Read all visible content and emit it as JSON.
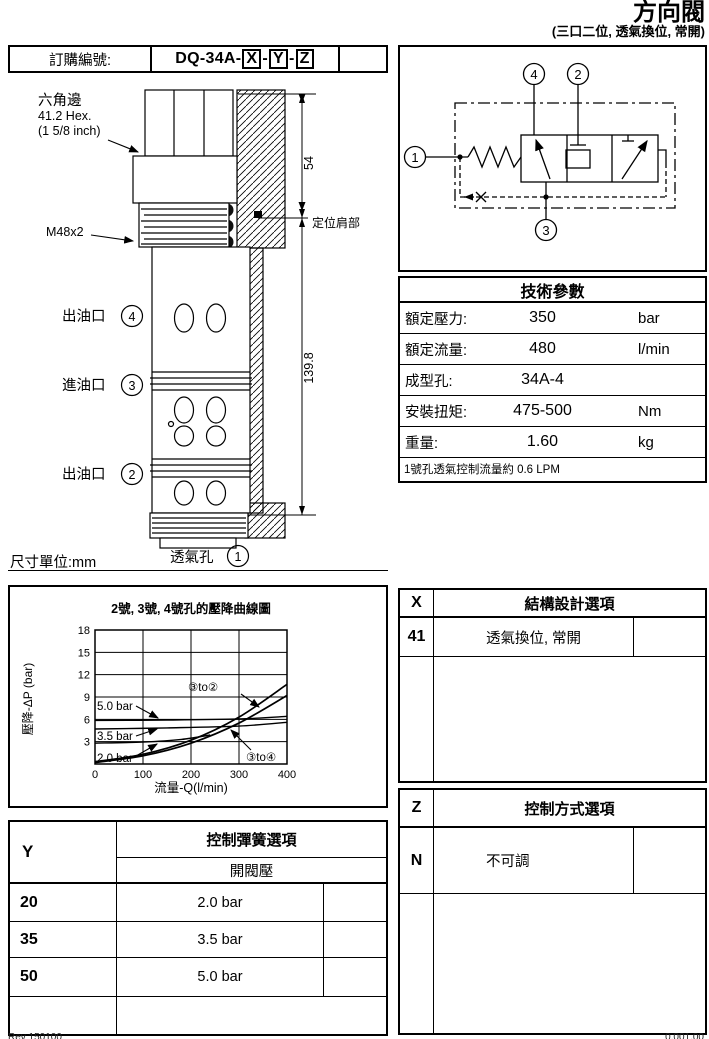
{
  "page": {
    "title": "方向閥",
    "subtitle": "(三口二位, 透氣換位, 常開)"
  },
  "order": {
    "label": "訂購編號:",
    "model_prefix": "DQ-34A-",
    "separator": "-",
    "codes": [
      "X",
      "Y",
      "Z"
    ]
  },
  "drawing": {
    "hex_label_1": "六角邊",
    "hex_label_2": "41.2 Hex.",
    "hex_label_3": "(1 5/8 inch)",
    "thread_label": "M48x2",
    "ports": [
      {
        "name": "出油口",
        "num": "4"
      },
      {
        "name": "進油口",
        "num": "3"
      },
      {
        "name": "出油口",
        "num": "2"
      }
    ],
    "vent_label": "透氣孔",
    "vent_num": "1",
    "dim_top": "54",
    "dim_main": "139.8",
    "shoulder_label": "定位肩部",
    "unit_note": "尺寸單位:mm"
  },
  "schematic": {
    "p1": "1",
    "p2": "2",
    "p3": "3",
    "p4": "4"
  },
  "tech": {
    "title": "技術參數",
    "rows": [
      {
        "label": "額定壓力:",
        "value": "350",
        "unit": "bar"
      },
      {
        "label": "額定流量:",
        "value": "480",
        "unit": "l/min"
      },
      {
        "label": "成型孔:",
        "value": "34A-4",
        "unit": ""
      },
      {
        "label": "安裝扭矩:",
        "value": "475-500",
        "unit": "Nm"
      },
      {
        "label": "重量:",
        "value": "1.60",
        "unit": "kg"
      }
    ],
    "note": "1號孔透氣控制流量約 0.6 LPM"
  },
  "chart_data": {
    "type": "line",
    "title": "2號, 3號, 4號孔的壓降曲線圖",
    "xlabel": "流量-Q(l/min)",
    "ylabel": "壓降-ΔP (bar)",
    "xlim": [
      0,
      400
    ],
    "ylim": [
      0,
      18
    ],
    "xticks": [
      0,
      100,
      200,
      300,
      400
    ],
    "yticks": [
      3,
      6,
      9,
      12,
      15,
      18
    ],
    "grid": true,
    "series": [
      {
        "name": "③to②",
        "x": [
          0,
          100,
          200,
          300,
          400
        ],
        "values": [
          0.3,
          1.3,
          3.2,
          6.3,
          10.7
        ]
      },
      {
        "name": "③to④",
        "x": [
          0,
          100,
          200,
          300,
          400
        ],
        "values": [
          0.2,
          1.1,
          2.8,
          5.5,
          9.2
        ]
      },
      {
        "name": "5.0 bar",
        "x": [
          0,
          150,
          300,
          400
        ],
        "values": [
          5.85,
          5.9,
          6.05,
          6.4
        ]
      },
      {
        "name": "3.5 bar",
        "x": [
          0,
          150,
          300,
          400
        ],
        "values": [
          4.7,
          4.85,
          5.1,
          5.6
        ]
      },
      {
        "name": "2.0 bar",
        "x": [
          0,
          100,
          180,
          240
        ],
        "values": [
          2.8,
          2.95,
          3.3,
          3.9
        ]
      }
    ]
  },
  "x_options": {
    "code": "X",
    "title": "結構設計選項",
    "rows": [
      {
        "code": "41",
        "label": "透氣換位, 常開"
      }
    ]
  },
  "y_options": {
    "code": "Y",
    "title": "控制彈簧選項",
    "subtitle": "開閥壓",
    "rows": [
      {
        "code": "20",
        "label": "2.0 bar"
      },
      {
        "code": "35",
        "label": "3.5 bar"
      },
      {
        "code": "50",
        "label": "5.0 bar"
      }
    ]
  },
  "z_options": {
    "code": "Z",
    "title": "控制方式選項",
    "rows": [
      {
        "code": "N",
        "label": "不可調"
      }
    ]
  },
  "footer": {
    "left": "Rev 150100",
    "right": "0.001.00"
  }
}
